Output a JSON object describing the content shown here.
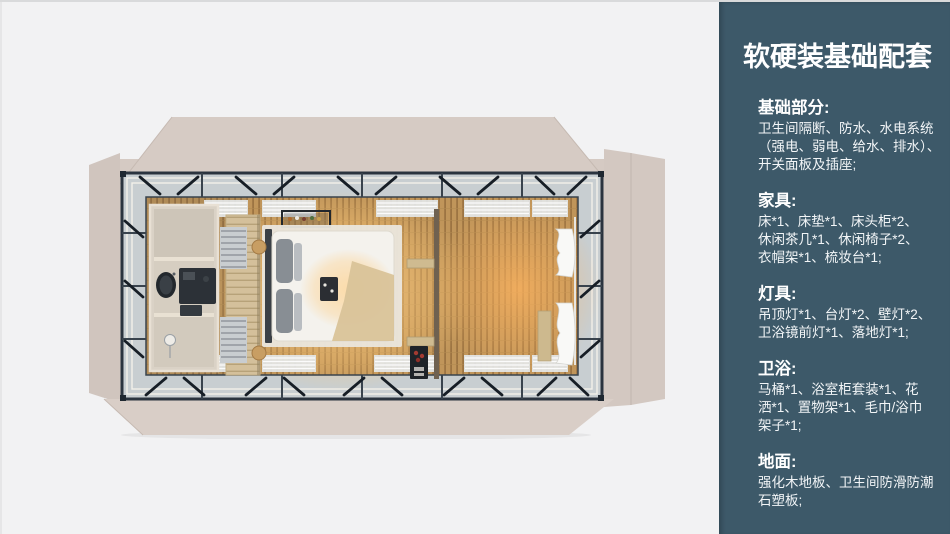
{
  "colors": {
    "page_bg": "#f2f2f3",
    "sidebar_bg": "#3d5969",
    "sidebar_text": "#ffffff",
    "panel_beige": "#d6cbc4",
    "frame_dark": "#2b343f",
    "glazing": "#c8ced1",
    "floor_wood": "#c0955a",
    "glow_warm": "#ffc069"
  },
  "sidebar": {
    "title": "软硬装基础配套",
    "sections": [
      {
        "heading": "基础部分:",
        "lines": [
          "卫生间隔断、防水、水电系统",
          "（强电、弱电、给水、排水）、",
          "开关面板及插座;"
        ]
      },
      {
        "heading": "家具:",
        "lines": [
          "床*1、床垫*1、床头柜*2、",
          "休闲茶几*1、休闲椅子*2、",
          "衣帽架*1、梳妆台*1;"
        ]
      },
      {
        "heading": "灯具:",
        "lines": [
          "吊顶灯*1、台灯*2、壁灯*2、",
          "卫浴镜前灯*1、落地灯*1;"
        ]
      },
      {
        "heading": "卫浴:",
        "lines": [
          "马桶*1、浴室柜套装*1、花",
          "洒*1、置物架*1、毛巾/浴巾",
          "架子*1;"
        ]
      },
      {
        "heading": "地面:",
        "lines": [
          "强化木地板、卫生间防滑防潮",
          "石塑板;"
        ]
      }
    ]
  }
}
